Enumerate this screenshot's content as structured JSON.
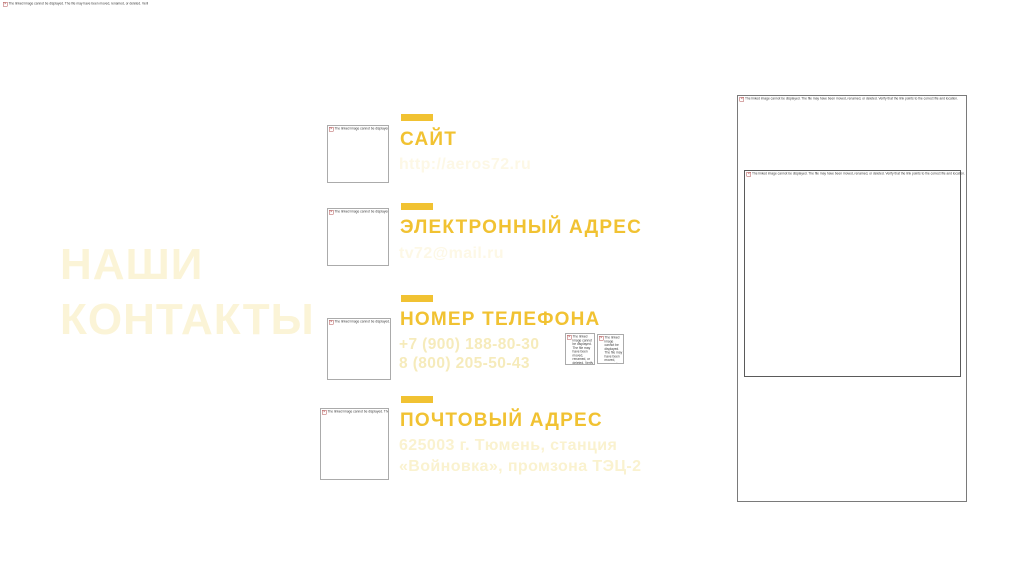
{
  "title": {
    "line1": "НАШИ",
    "line2": "КОНТАКТЫ"
  },
  "sections": [
    {
      "heading": "САЙТ",
      "line1": "http://aeros72.ru"
    },
    {
      "heading": "ЭЛЕКТРОННЫЙ АДРЕС",
      "line1": "tv72@mail.ru"
    },
    {
      "heading": "НОМЕР ТЕЛЕФОНА",
      "line1": "+7 (900) 188-80-30",
      "line2": "8 (800) 205-50-43"
    },
    {
      "heading": "ПОЧТОВЫЙ АДРЕС",
      "line1": "625003 г. Тюмень, станция",
      "line2": "«Войновка», промзона ТЭЦ-2"
    }
  ],
  "placeholders": {
    "broken_image_text": "The linked image cannot be displayed. The file may have been moved, renamed, or deleted. Verify that the link points to the correct file and location.",
    "broken_image_glyph": "✕"
  },
  "colors": {
    "accent": "#F1C232",
    "title": "#FBF4D7",
    "faint": "#FDF8E6",
    "phone": "#F6EBBB",
    "postal": "#FAF2CF",
    "border": "#ABABAB",
    "frame": "#7A7A7A",
    "frame_inner": "#5A5A5A",
    "note": "#3B3B3B"
  }
}
